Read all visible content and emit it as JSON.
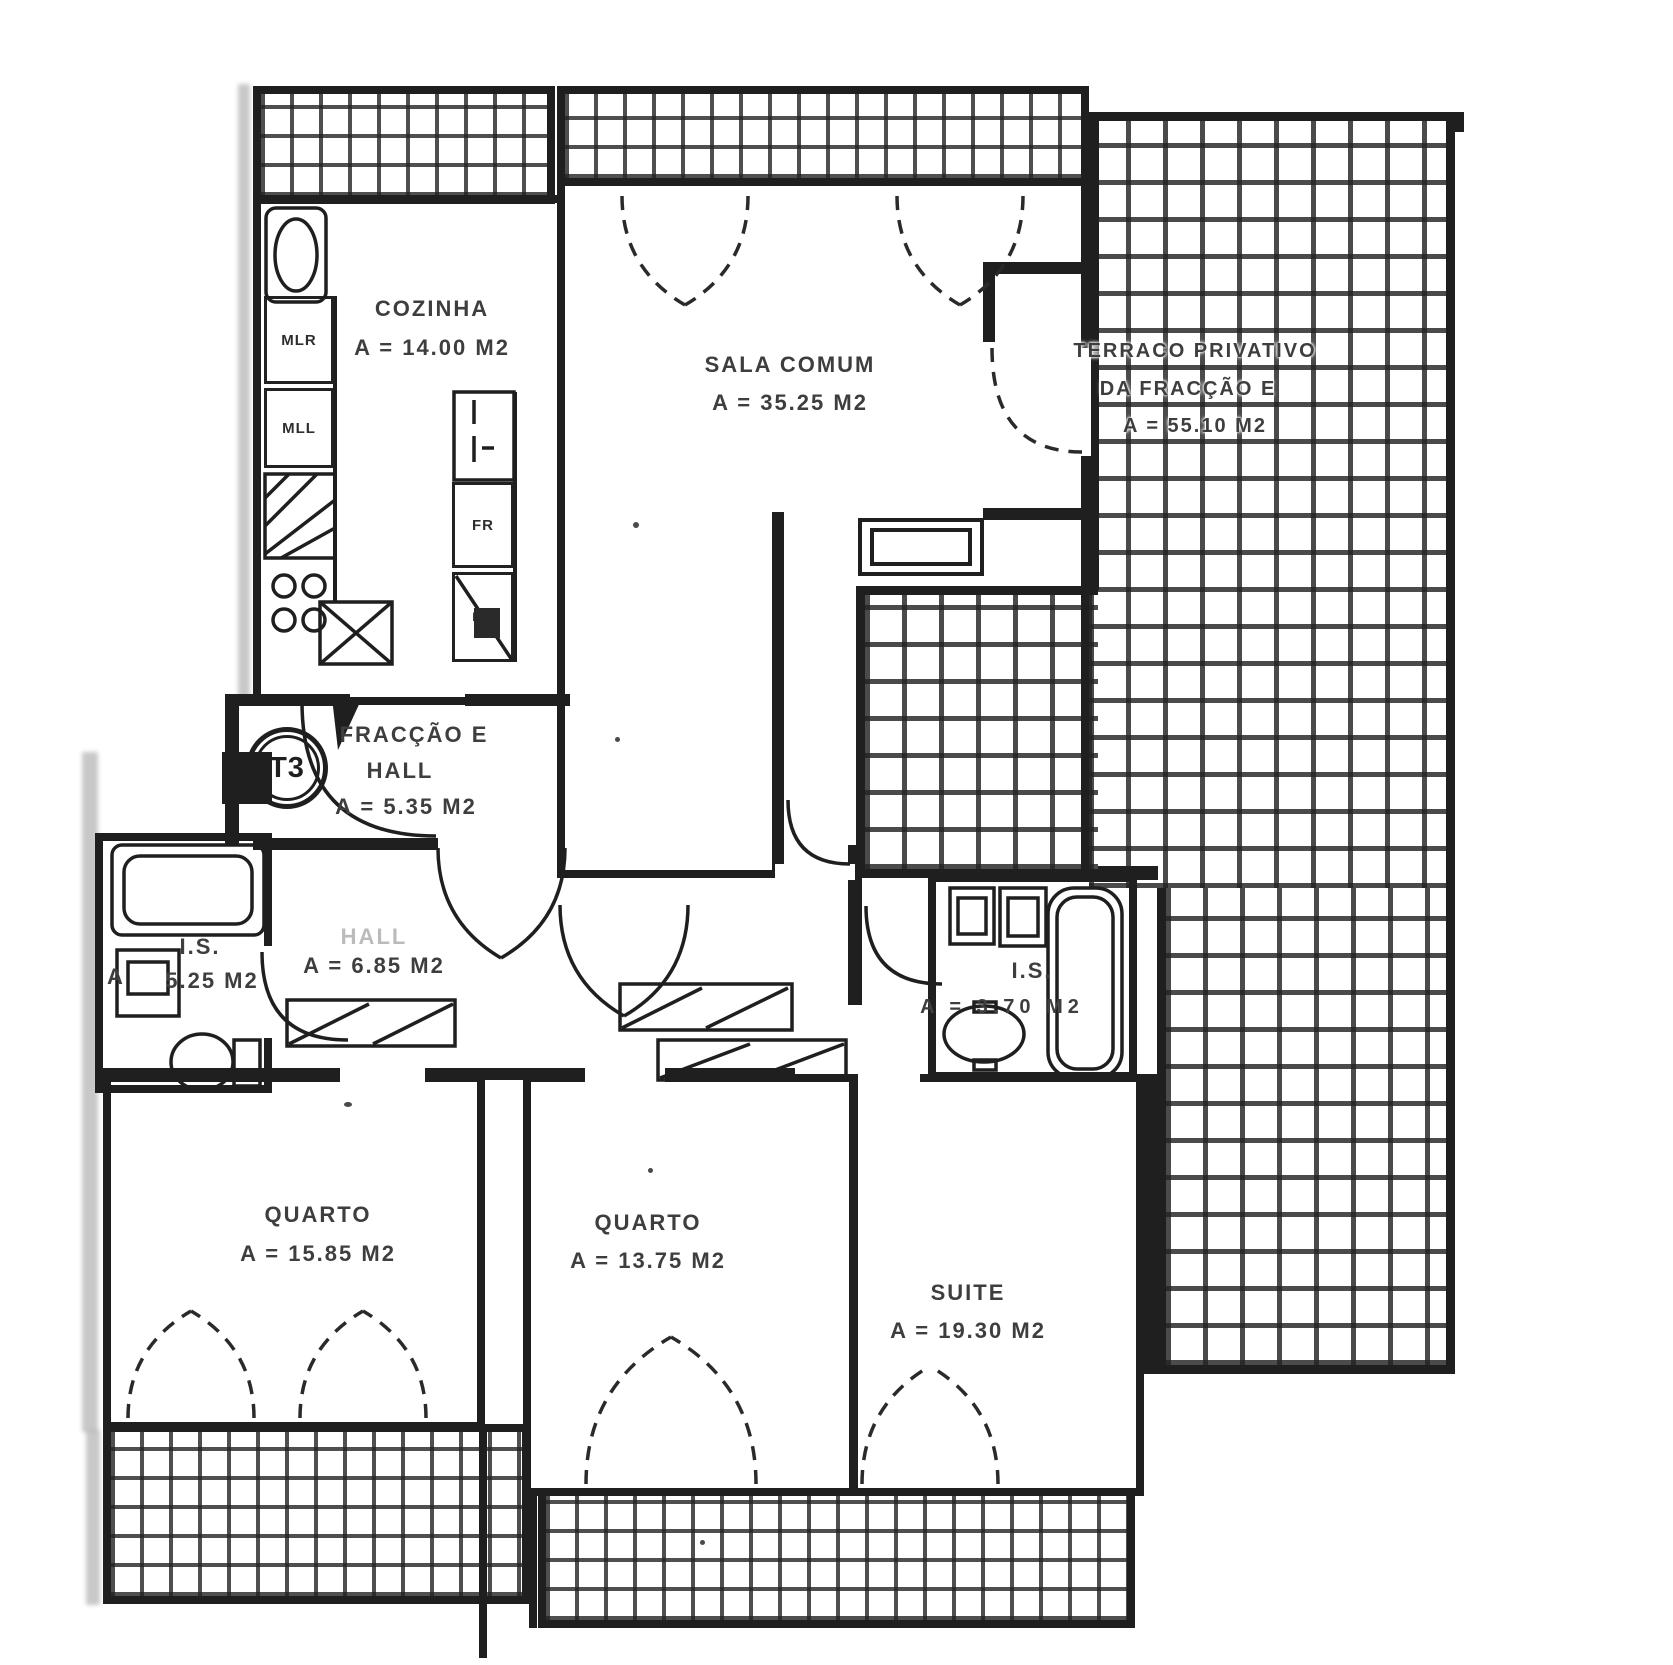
{
  "plan": {
    "badge": "T3",
    "rooms": [
      {
        "id": "cozinha",
        "name": "COZINHA",
        "area": "A = 14.00 M2"
      },
      {
        "id": "sala-comum",
        "name": "SALA COMUM",
        "area": "A = 35.25 M2"
      },
      {
        "id": "terraco",
        "name": "TERRACO PRIVATIVO",
        "subname": "DA FRACÇÃO E",
        "area": "A = 55.10 M2"
      },
      {
        "id": "fraccao-hall",
        "name": "FRACÇÃO E",
        "subname": "HALL",
        "area": "A = 5.35 M2"
      },
      {
        "id": "hall",
        "name": "HALL",
        "area": "A = 6.85 M2"
      },
      {
        "id": "is-esquerda",
        "name": "I.S.",
        "prefix": "A",
        "area": "5.25 M2"
      },
      {
        "id": "is-direita",
        "name": "I.S.",
        "area": "A = 3.70 M2"
      },
      {
        "id": "quarto-1",
        "name": "QUARTO",
        "area": "A = 15.85 M2"
      },
      {
        "id": "quarto-2",
        "name": "QUARTO",
        "area": "A = 13.75 M2"
      },
      {
        "id": "suite",
        "name": "SUITE",
        "area": "A = 19.30 M2"
      }
    ],
    "appliances": [
      {
        "id": "mlr",
        "label": "MLR"
      },
      {
        "id": "mll",
        "label": "MLL"
      },
      {
        "id": "fr",
        "label": "FR"
      },
      {
        "id": "mo",
        "label": "MO"
      }
    ],
    "colors": {
      "ink": "#1f1f1f",
      "text": "#3e3e3e",
      "paper": "#ffffff"
    }
  }
}
